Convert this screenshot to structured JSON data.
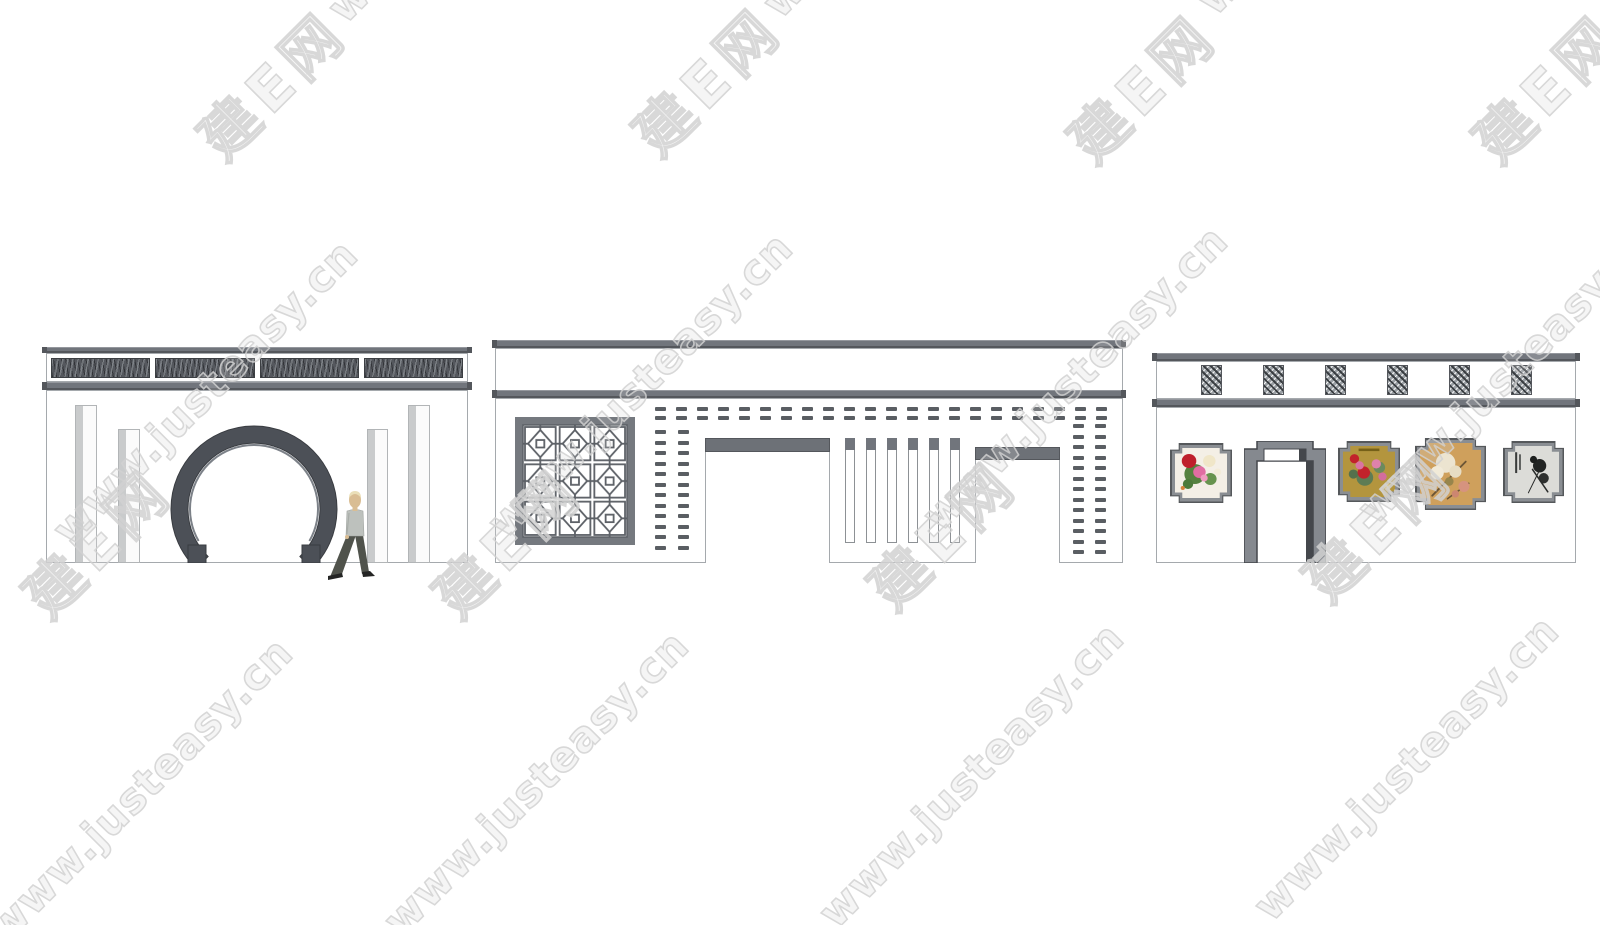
{
  "watermark": {
    "cn_text": "建E网",
    "url_text": "www.justeasy.cn",
    "instances": [
      {
        "type": "cn",
        "x": 270,
        "y": 82
      },
      {
        "type": "cn",
        "x": 705,
        "y": 78
      },
      {
        "type": "cn",
        "x": 1140,
        "y": 85
      },
      {
        "type": "cn",
        "x": 1545,
        "y": 85
      },
      {
        "type": "cn",
        "x": 95,
        "y": 540
      },
      {
        "type": "cn",
        "x": 505,
        "y": 540
      },
      {
        "type": "cn",
        "x": 940,
        "y": 532
      },
      {
        "type": "cn",
        "x": 1375,
        "y": 524
      },
      {
        "type": "url",
        "x": 480,
        "y": -130
      },
      {
        "type": "url",
        "x": 915,
        "y": -135
      },
      {
        "type": "url",
        "x": 1350,
        "y": -138
      },
      {
        "type": "url",
        "x": 205,
        "y": 392
      },
      {
        "type": "url",
        "x": 640,
        "y": 385
      },
      {
        "type": "url",
        "x": 1075,
        "y": 378
      },
      {
        "type": "url",
        "x": 1510,
        "y": 371
      },
      {
        "type": "url",
        "x": 140,
        "y": 790
      },
      {
        "type": "url",
        "x": 536,
        "y": 783
      },
      {
        "type": "url",
        "x": 971,
        "y": 775
      },
      {
        "type": "url",
        "x": 1406,
        "y": 768
      }
    ]
  },
  "palette": {
    "bar": "#71757c",
    "bar_dark": "#54575c",
    "outline": "#a5a9ad",
    "panel": "#55585e",
    "dash": "#5a5e63",
    "beam": "#6d7177",
    "arch": "#85898f",
    "arch_dark": "#44474c",
    "frame": "#8a8e93",
    "frame_dark": "#55585b",
    "lattice_line": "#5c6066",
    "lattice_frame": "#75797f",
    "ring": "#4c5057",
    "ring_hi": "#7c8188",
    "pilaster": "#c9cbcc",
    "skin": "#d9bd93",
    "hair": "#eadfb8",
    "shirt": "#bdc1bd",
    "pants": "#50534c",
    "shoes": "#242524",
    "watermark": "#d2d2d2"
  },
  "left_wall": {
    "name": "moon-gate-wall",
    "frieze_panel_count": 4,
    "pilaster_count": 4,
    "has_moon_gate": true,
    "has_walking_person": true
  },
  "middle_wall": {
    "name": "lattice-screen-wall",
    "brick_dash_row_count": 22,
    "brick_dash_col_count": 12,
    "brick_dash_col_count_right": 13,
    "slat_count": 6,
    "doorway_count": 2,
    "has_lattice_window": true
  },
  "right_wall": {
    "name": "gallery-wall",
    "frieze_window_count": 6,
    "has_stepped_arch_doorway": true,
    "paintings": [
      {
        "name": "peony-white",
        "bg": "#f4efe6",
        "motifs": [
          {
            "s": "c",
            "c": "#55813f",
            "x": 38,
            "y": 52,
            "r": 20
          },
          {
            "s": "c",
            "c": "#67934e",
            "x": 68,
            "y": 62,
            "r": 12
          },
          {
            "s": "c",
            "c": "#4d7a3a",
            "x": 25,
            "y": 72,
            "r": 10
          },
          {
            "s": "c",
            "c": "#f0e6c8",
            "x": 66,
            "y": 26,
            "r": 12
          },
          {
            "s": "c",
            "c": "#bf1f2c",
            "x": 27,
            "y": 26,
            "r": 14
          },
          {
            "s": "c",
            "c": "#e06da2",
            "x": 47,
            "y": 48,
            "r": 12
          },
          {
            "s": "c",
            "c": "#ef9cc0",
            "x": 56,
            "y": 60,
            "r": 7
          },
          {
            "s": "c",
            "c": "#f3ecd9",
            "x": 82,
            "y": 48,
            "r": 7
          },
          {
            "s": "c",
            "c": "#d9823b",
            "x": 15,
            "y": 80,
            "r": 4
          }
        ]
      },
      {
        "name": "peony-gold",
        "bg": "#b3953e",
        "motifs": [
          {
            "s": "c",
            "c": "#5e7c54",
            "x": 42,
            "y": 62,
            "r": 16
          },
          {
            "s": "c",
            "c": "#6b8a5e",
            "x": 70,
            "y": 42,
            "r": 11
          },
          {
            "s": "c",
            "c": "#54714c",
            "x": 20,
            "y": 55,
            "r": 9
          },
          {
            "s": "c",
            "c": "#c2222b",
            "x": 22,
            "y": 25,
            "r": 9
          },
          {
            "s": "c",
            "c": "#c2222b",
            "x": 40,
            "y": 52,
            "r": 12
          },
          {
            "s": "c",
            "c": "#da74a2",
            "x": 32,
            "y": 38,
            "r": 8
          },
          {
            "s": "c",
            "c": "#de82ab",
            "x": 64,
            "y": 35,
            "r": 9
          },
          {
            "s": "c",
            "c": "#d36d9d",
            "x": 76,
            "y": 60,
            "r": 8
          },
          {
            "s": "c",
            "c": "#e3b94a",
            "x": 85,
            "y": 80,
            "r": 6
          },
          {
            "s": "b",
            "c": "#756018",
            "x": 30,
            "y": 5,
            "w": 40,
            "h": 5
          }
        ]
      },
      {
        "name": "blossom-tan",
        "bg": "#cfa05c",
        "motifs": [
          {
            "s": "l",
            "c": "#6b5536",
            "x": 20,
            "y": 85,
            "X": 75,
            "Y": 30,
            "w": 3
          },
          {
            "s": "l",
            "c": "#6b5536",
            "x": 45,
            "y": 90,
            "X": 80,
            "Y": 65,
            "w": 2.5
          },
          {
            "s": "c",
            "c": "#ece4d0",
            "x": 42,
            "y": 32,
            "r": 16
          },
          {
            "s": "c",
            "c": "#f1ead8",
            "x": 28,
            "y": 48,
            "r": 11
          },
          {
            "s": "c",
            "c": "#e7ddc4",
            "x": 58,
            "y": 46,
            "r": 10
          },
          {
            "s": "c",
            "c": "#d6937f",
            "x": 72,
            "y": 70,
            "r": 9
          },
          {
            "s": "c",
            "c": "#cc8670",
            "x": 58,
            "y": 82,
            "r": 6
          },
          {
            "s": "c",
            "c": "#97854c",
            "x": 48,
            "y": 62,
            "r": 7
          }
        ]
      },
      {
        "name": "ink-painting",
        "bg": "#dcdcd8",
        "motifs": [
          {
            "s": "c",
            "c": "#222423",
            "x": 62,
            "y": 38,
            "r": 13
          },
          {
            "s": "c",
            "c": "#2e302f",
            "x": 70,
            "y": 62,
            "r": 10
          },
          {
            "s": "c",
            "c": "#1d1f1e",
            "x": 50,
            "y": 26,
            "r": 7
          },
          {
            "s": "l",
            "c": "#2a2c2b",
            "x": 48,
            "y": 45,
            "X": 78,
            "Y": 88,
            "w": 3
          },
          {
            "s": "l",
            "c": "#2a2c2b",
            "x": 60,
            "y": 50,
            "X": 40,
            "Y": 90,
            "w": 2
          },
          {
            "s": "b",
            "c": "#3a3c3b",
            "x": 14,
            "y": 12,
            "w": 4,
            "h": 40
          },
          {
            "s": "b",
            "c": "#3a3c3b",
            "x": 22,
            "y": 16,
            "w": 3,
            "h": 30
          }
        ]
      }
    ]
  }
}
